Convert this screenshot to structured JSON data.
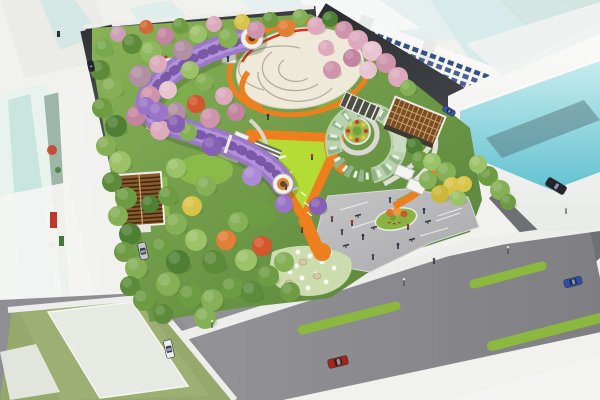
{
  "scene": {
    "subject": "aerial rendering of an urban pocket-park master plan",
    "view": "bird's-eye isometric",
    "features": [
      "central-oval-plaza",
      "wisteria-tunnel",
      "orange-loop-paths",
      "triangular-lime-lawn",
      "spiral-canopy-garden",
      "lattice-pavilion",
      "louvered-roof-building",
      "gray-entry-plaza",
      "flower-rock-garden",
      "planted-traffic-island",
      "surrounding-streets",
      "glass-office-towers",
      "shop-house-row"
    ]
  },
  "palette": {
    "background": "#f1f1ee",
    "road_dark": "#3a3c41",
    "road_medium": "#6e7074",
    "sidewalk": "#ededeb",
    "median_green": "#8cb83f",
    "park_base": "#6f9e4a",
    "lawn_lime": "#b5dc34",
    "path_orange": "#ee7f1e",
    "accent_red": "#d83418",
    "plaza_paving": "#efe9da",
    "tunnel_purple": "#9b79c6",
    "tunnel_light": "#b392dd",
    "tunnel_dark": "#7c59a8",
    "glass_cyan": "#7fd0da",
    "glass_pale": "#d5eaea",
    "building_white": "#f4f4f1",
    "window_blue": "#24407e",
    "pergola_brown": "#8a5a2e",
    "lattice_brown": "#7a4c24",
    "khaki": "#c5c08a",
    "flower_bed_green": "#9ab84e",
    "island_green": "#8ab441",
    "garden_pale": "#ccdcae"
  },
  "park": {
    "trees": [
      [
        104,
        48,
        9,
        "#79a94e"
      ],
      [
        118,
        34,
        8,
        "#caa0b4"
      ],
      [
        132,
        44,
        10,
        "#5d8b3a"
      ],
      [
        146,
        27,
        7,
        "#d0693a"
      ],
      [
        151,
        52,
        11,
        "#8fb85c"
      ],
      [
        165,
        36,
        9,
        "#c284a0"
      ],
      [
        180,
        26,
        8,
        "#6d9c42"
      ],
      [
        183,
        50,
        10,
        "#b38fa4"
      ],
      [
        198,
        34,
        9,
        "#9cc268"
      ],
      [
        214,
        24,
        8,
        "#dcaabc"
      ],
      [
        228,
        38,
        10,
        "#85b055"
      ],
      [
        242,
        22,
        8,
        "#d9c44a"
      ],
      [
        256,
        30,
        9,
        "#cf93ab"
      ],
      [
        270,
        20,
        8,
        "#6d9c42"
      ],
      [
        286,
        28,
        9,
        "#e07f35"
      ],
      [
        300,
        17,
        8,
        "#85b055"
      ],
      [
        316,
        26,
        9,
        "#dcaabc"
      ],
      [
        330,
        19,
        8,
        "#4e7f33"
      ],
      [
        344,
        30,
        9,
        "#cf93ab"
      ],
      [
        358,
        40,
        10,
        "#dcaabc"
      ],
      [
        372,
        51,
        10,
        "#e7c4d0"
      ],
      [
        386,
        63,
        10,
        "#cf93ab"
      ],
      [
        398,
        77,
        10,
        "#dcaabc"
      ],
      [
        352,
        58,
        9,
        "#c284a0"
      ],
      [
        368,
        70,
        9,
        "#e7c4d0"
      ],
      [
        100,
        70,
        10,
        "#5d8b3a"
      ],
      [
        112,
        88,
        11,
        "#85b055"
      ],
      [
        102,
        108,
        10,
        "#6d9c42"
      ],
      [
        116,
        126,
        11,
        "#4e7f33"
      ],
      [
        106,
        146,
        10,
        "#85b055"
      ],
      [
        120,
        162,
        11,
        "#9cc268"
      ],
      [
        112,
        182,
        10,
        "#5d8b3a"
      ],
      [
        126,
        198,
        11,
        "#6d9c42"
      ],
      [
        118,
        216,
        10,
        "#85b055"
      ],
      [
        130,
        234,
        11,
        "#4e7f33"
      ],
      [
        124,
        252,
        10,
        "#6d9c42"
      ],
      [
        136,
        268,
        11,
        "#85b055"
      ],
      [
        130,
        286,
        10,
        "#5d8b3a"
      ],
      [
        144,
        300,
        11,
        "#6d9c42"
      ],
      [
        163,
        314,
        10,
        "#5d8b3a"
      ],
      [
        140,
        76,
        11,
        "#b38fa4"
      ],
      [
        158,
        64,
        9,
        "#dcaabc"
      ],
      [
        150,
        96,
        10,
        "#cf93ab"
      ],
      [
        136,
        116,
        10,
        "#c284a0"
      ],
      [
        168,
        90,
        9,
        "#e7c4d0"
      ],
      [
        176,
        112,
        10,
        "#b38fa4"
      ],
      [
        160,
        130,
        10,
        "#dcaabc"
      ],
      [
        190,
        70,
        9,
        "#9cc268"
      ],
      [
        204,
        82,
        9,
        "#85b055"
      ],
      [
        196,
        104,
        9,
        "#d4562c"
      ],
      [
        210,
        118,
        10,
        "#cf93ab"
      ],
      [
        188,
        132,
        9,
        "#85b055"
      ],
      [
        224,
        96,
        9,
        "#dcaabc"
      ],
      [
        236,
        112,
        9,
        "#c284a0"
      ],
      [
        168,
        196,
        10,
        "#6d9c42"
      ],
      [
        176,
        168,
        10,
        "#9cc268"
      ],
      [
        150,
        204,
        9,
        "#4e7f33"
      ],
      [
        176,
        224,
        11,
        "#85b055"
      ],
      [
        162,
        248,
        11,
        "#6d9c42"
      ],
      [
        178,
        262,
        12,
        "#4e7f33"
      ],
      [
        168,
        284,
        12,
        "#85b055"
      ],
      [
        190,
        296,
        12,
        "#6d9c42"
      ],
      [
        196,
        240,
        11,
        "#9cc268"
      ],
      [
        192,
        206,
        10,
        "#d9c44a"
      ],
      [
        206,
        186,
        10,
        "#85b055"
      ],
      [
        214,
        262,
        12,
        "#5d8b3a"
      ],
      [
        212,
        300,
        11,
        "#85b055"
      ],
      [
        232,
        288,
        11,
        "#6d9c42"
      ],
      [
        226,
        240,
        10,
        "#e07f35"
      ],
      [
        238,
        222,
        10,
        "#85b055"
      ],
      [
        246,
        260,
        11,
        "#9cc268"
      ],
      [
        252,
        292,
        11,
        "#5d8b3a"
      ],
      [
        268,
        276,
        11,
        "#6d9c42"
      ],
      [
        262,
        246,
        10,
        "#d4562c"
      ],
      [
        284,
        262,
        10,
        "#85b055"
      ],
      [
        290,
        292,
        10,
        "#6d9c42"
      ],
      [
        205,
        318,
        11,
        "#85b055"
      ],
      [
        146,
        106,
        9,
        "#9a74c8"
      ],
      [
        158,
        112,
        10,
        "#9a74c8"
      ],
      [
        176,
        124,
        9,
        "#8660b4"
      ],
      [
        212,
        146,
        10,
        "#8660b4"
      ],
      [
        252,
        176,
        10,
        "#ab8ad6"
      ],
      [
        284,
        204,
        9,
        "#9a74c8"
      ],
      [
        318,
        206,
        9,
        "#8660b4"
      ],
      [
        332,
        70,
        9,
        "#cf93ab"
      ],
      [
        326,
        48,
        8,
        "#dcaabc"
      ],
      [
        408,
        88,
        8,
        "#85b055"
      ],
      [
        414,
        146,
        8,
        "#4e7f33"
      ],
      [
        420,
        160,
        9,
        "#6d9c42"
      ],
      [
        432,
        162,
        9,
        "#9cc268"
      ],
      [
        446,
        172,
        10,
        "#85b055"
      ],
      [
        452,
        186,
        9,
        "#d9c44a"
      ],
      [
        440,
        194,
        9,
        "#c8b83a"
      ],
      [
        458,
        198,
        8,
        "#9cc268"
      ],
      [
        428,
        180,
        9,
        "#85b055"
      ],
      [
        464,
        184,
        8,
        "#d9c44a"
      ],
      [
        488,
        176,
        10,
        "#6d9c42"
      ],
      [
        500,
        190,
        10,
        "#85b055"
      ],
      [
        478,
        164,
        9,
        "#9cc268"
      ],
      [
        508,
        202,
        8,
        "#6d9c42"
      ]
    ],
    "flowers": [
      [
        288,
        258
      ],
      [
        298,
        252
      ],
      [
        310,
        256
      ],
      [
        322,
        262
      ],
      [
        334,
        268
      ],
      [
        316,
        274
      ],
      [
        302,
        278
      ],
      [
        290,
        272
      ],
      [
        326,
        282
      ],
      [
        308,
        288
      ],
      [
        296,
        266
      ],
      [
        330,
        254
      ]
    ],
    "rocks": [
      [
        303,
        262
      ],
      [
        317,
        276
      ],
      [
        289,
        283
      ]
    ]
  },
  "traffic": {
    "cars": [
      {
        "x": 143,
        "y": 251,
        "a": 78,
        "len": 17,
        "wid": 8,
        "color": "#c6c8cc"
      },
      {
        "x": 169,
        "y": 349,
        "a": 78,
        "len": 18,
        "wid": 8,
        "color": "#eceff1"
      },
      {
        "x": 338,
        "y": 362,
        "a": -14,
        "len": 20,
        "wid": 9,
        "color": "#a82318"
      },
      {
        "x": 573,
        "y": 282,
        "a": -14,
        "len": 18,
        "wid": 8,
        "color": "#2c4fae"
      },
      {
        "x": 556,
        "y": 186,
        "a": 31,
        "len": 21,
        "wid": 9,
        "color": "#23262d"
      },
      {
        "x": 449,
        "y": 111,
        "a": 31,
        "len": 13,
        "wid": 6,
        "color": "#3156b4"
      },
      {
        "x": 91,
        "y": 66,
        "a": 78,
        "len": 11,
        "wid": 6,
        "color": "#22262c"
      }
    ],
    "medians": [
      [
        302,
        330,
        396,
        306,
        9
      ],
      [
        474,
        284,
        542,
        266,
        9
      ],
      [
        492,
        346,
        600,
        318,
        10
      ]
    ]
  },
  "people": [
    [
      352,
      224
    ],
    [
      363,
      238
    ],
    [
      342,
      233
    ],
    [
      408,
      228
    ],
    [
      424,
      212
    ],
    [
      390,
      201
    ],
    [
      332,
      220
    ],
    [
      398,
      247
    ],
    [
      373,
      258
    ],
    [
      302,
      231
    ],
    [
      268,
      118
    ],
    [
      286,
      188
    ],
    [
      312,
      158
    ],
    [
      228,
      60
    ],
    [
      434,
      262
    ]
  ],
  "furniture": {
    "benches": [
      [
        358,
        216
      ],
      [
        374,
        228
      ],
      [
        346,
        246
      ],
      [
        412,
        240
      ],
      [
        428,
        222
      ]
    ],
    "lamps": [
      [
        212,
        328
      ],
      [
        404,
        286
      ],
      [
        508,
        254
      ],
      [
        566,
        214
      ]
    ]
  },
  "shop_row_windows": {
    "rows": 3,
    "cols": 21
  }
}
